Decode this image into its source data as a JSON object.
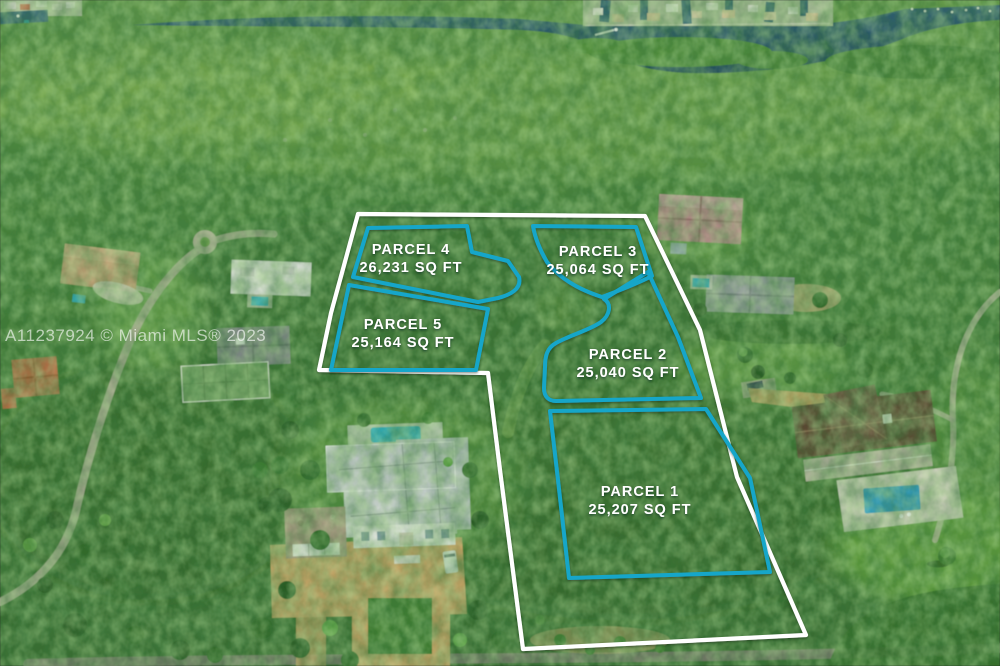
{
  "watermark": {
    "text": "A11237924 © Miami MLS® 2023"
  },
  "parcels": [
    {
      "id": "parcel-1",
      "name": "PARCEL 1",
      "area": "25,207 SQ FT"
    },
    {
      "id": "parcel-2",
      "name": "PARCEL 2",
      "area": "25,040 SQ FT"
    },
    {
      "id": "parcel-3",
      "name": "PARCEL 3",
      "area": "25,064 SQ FT"
    },
    {
      "id": "parcel-4",
      "name": "PARCEL 4",
      "area": "26,231 SQ FT"
    },
    {
      "id": "parcel-5",
      "name": "PARCEL 5",
      "area": "25,164 SQ FT"
    }
  ],
  "colors": {
    "parcel_line": "#15a6c9",
    "outer_boundary": "#ffffff",
    "label_text": "#ffffff",
    "water": "#27516b"
  }
}
